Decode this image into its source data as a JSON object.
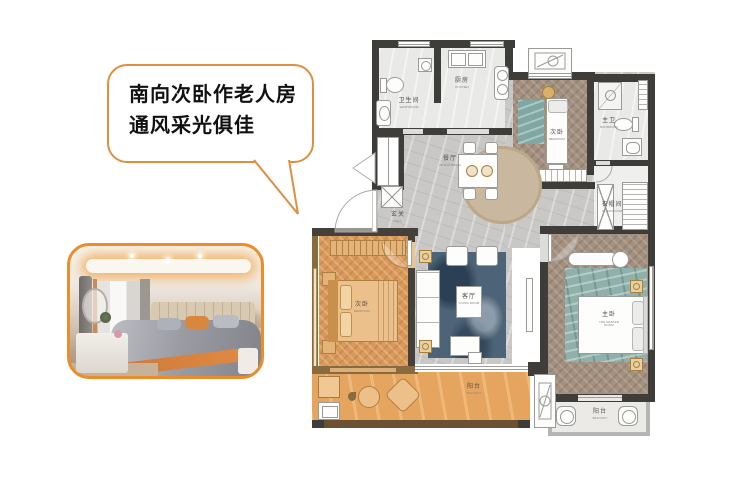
{
  "colors": {
    "accent": "#e8913c",
    "highlight_floor": "#d9995b",
    "wall": "#3f3d3a",
    "wood_floor": "#a3907f",
    "marble_floor": "#c9c8c6",
    "rug_blue": "#4d6478",
    "rug_teal": "#8fb0ab"
  },
  "callout": {
    "line1": "南向次卧作老人房",
    "line2": "通风采光俱佳"
  },
  "floorplan": {
    "rooms": [
      {
        "id": "bathroom",
        "label": "卫生间",
        "sub": "WASHROOM"
      },
      {
        "id": "kitchen",
        "label": "厨房",
        "sub": "KITCHEN"
      },
      {
        "id": "bedroom-north",
        "label": "次卧",
        "sub": "BEDROOM"
      },
      {
        "id": "master-bathroom",
        "label": "主卫",
        "sub": "BATHROOM"
      },
      {
        "id": "cloakroom",
        "label": "衣帽间",
        "sub": "CLOAKROOM"
      },
      {
        "id": "entry",
        "label": "玄关",
        "sub": "HALL"
      },
      {
        "id": "dining",
        "label": "餐厅",
        "sub": "DINING ROOM"
      },
      {
        "id": "living",
        "label": "客厅",
        "sub": "LIVING ROOM"
      },
      {
        "id": "bedroom-south",
        "label": "次卧",
        "sub": "BEDROOM"
      },
      {
        "id": "master-bedroom",
        "label": "主卧",
        "sub": "THE MASTER ROOM"
      },
      {
        "id": "balcony-main",
        "label": "阳台",
        "sub": "BALCONY"
      },
      {
        "id": "balcony-small",
        "label": "阳台",
        "sub": "BALCONY"
      }
    ]
  }
}
